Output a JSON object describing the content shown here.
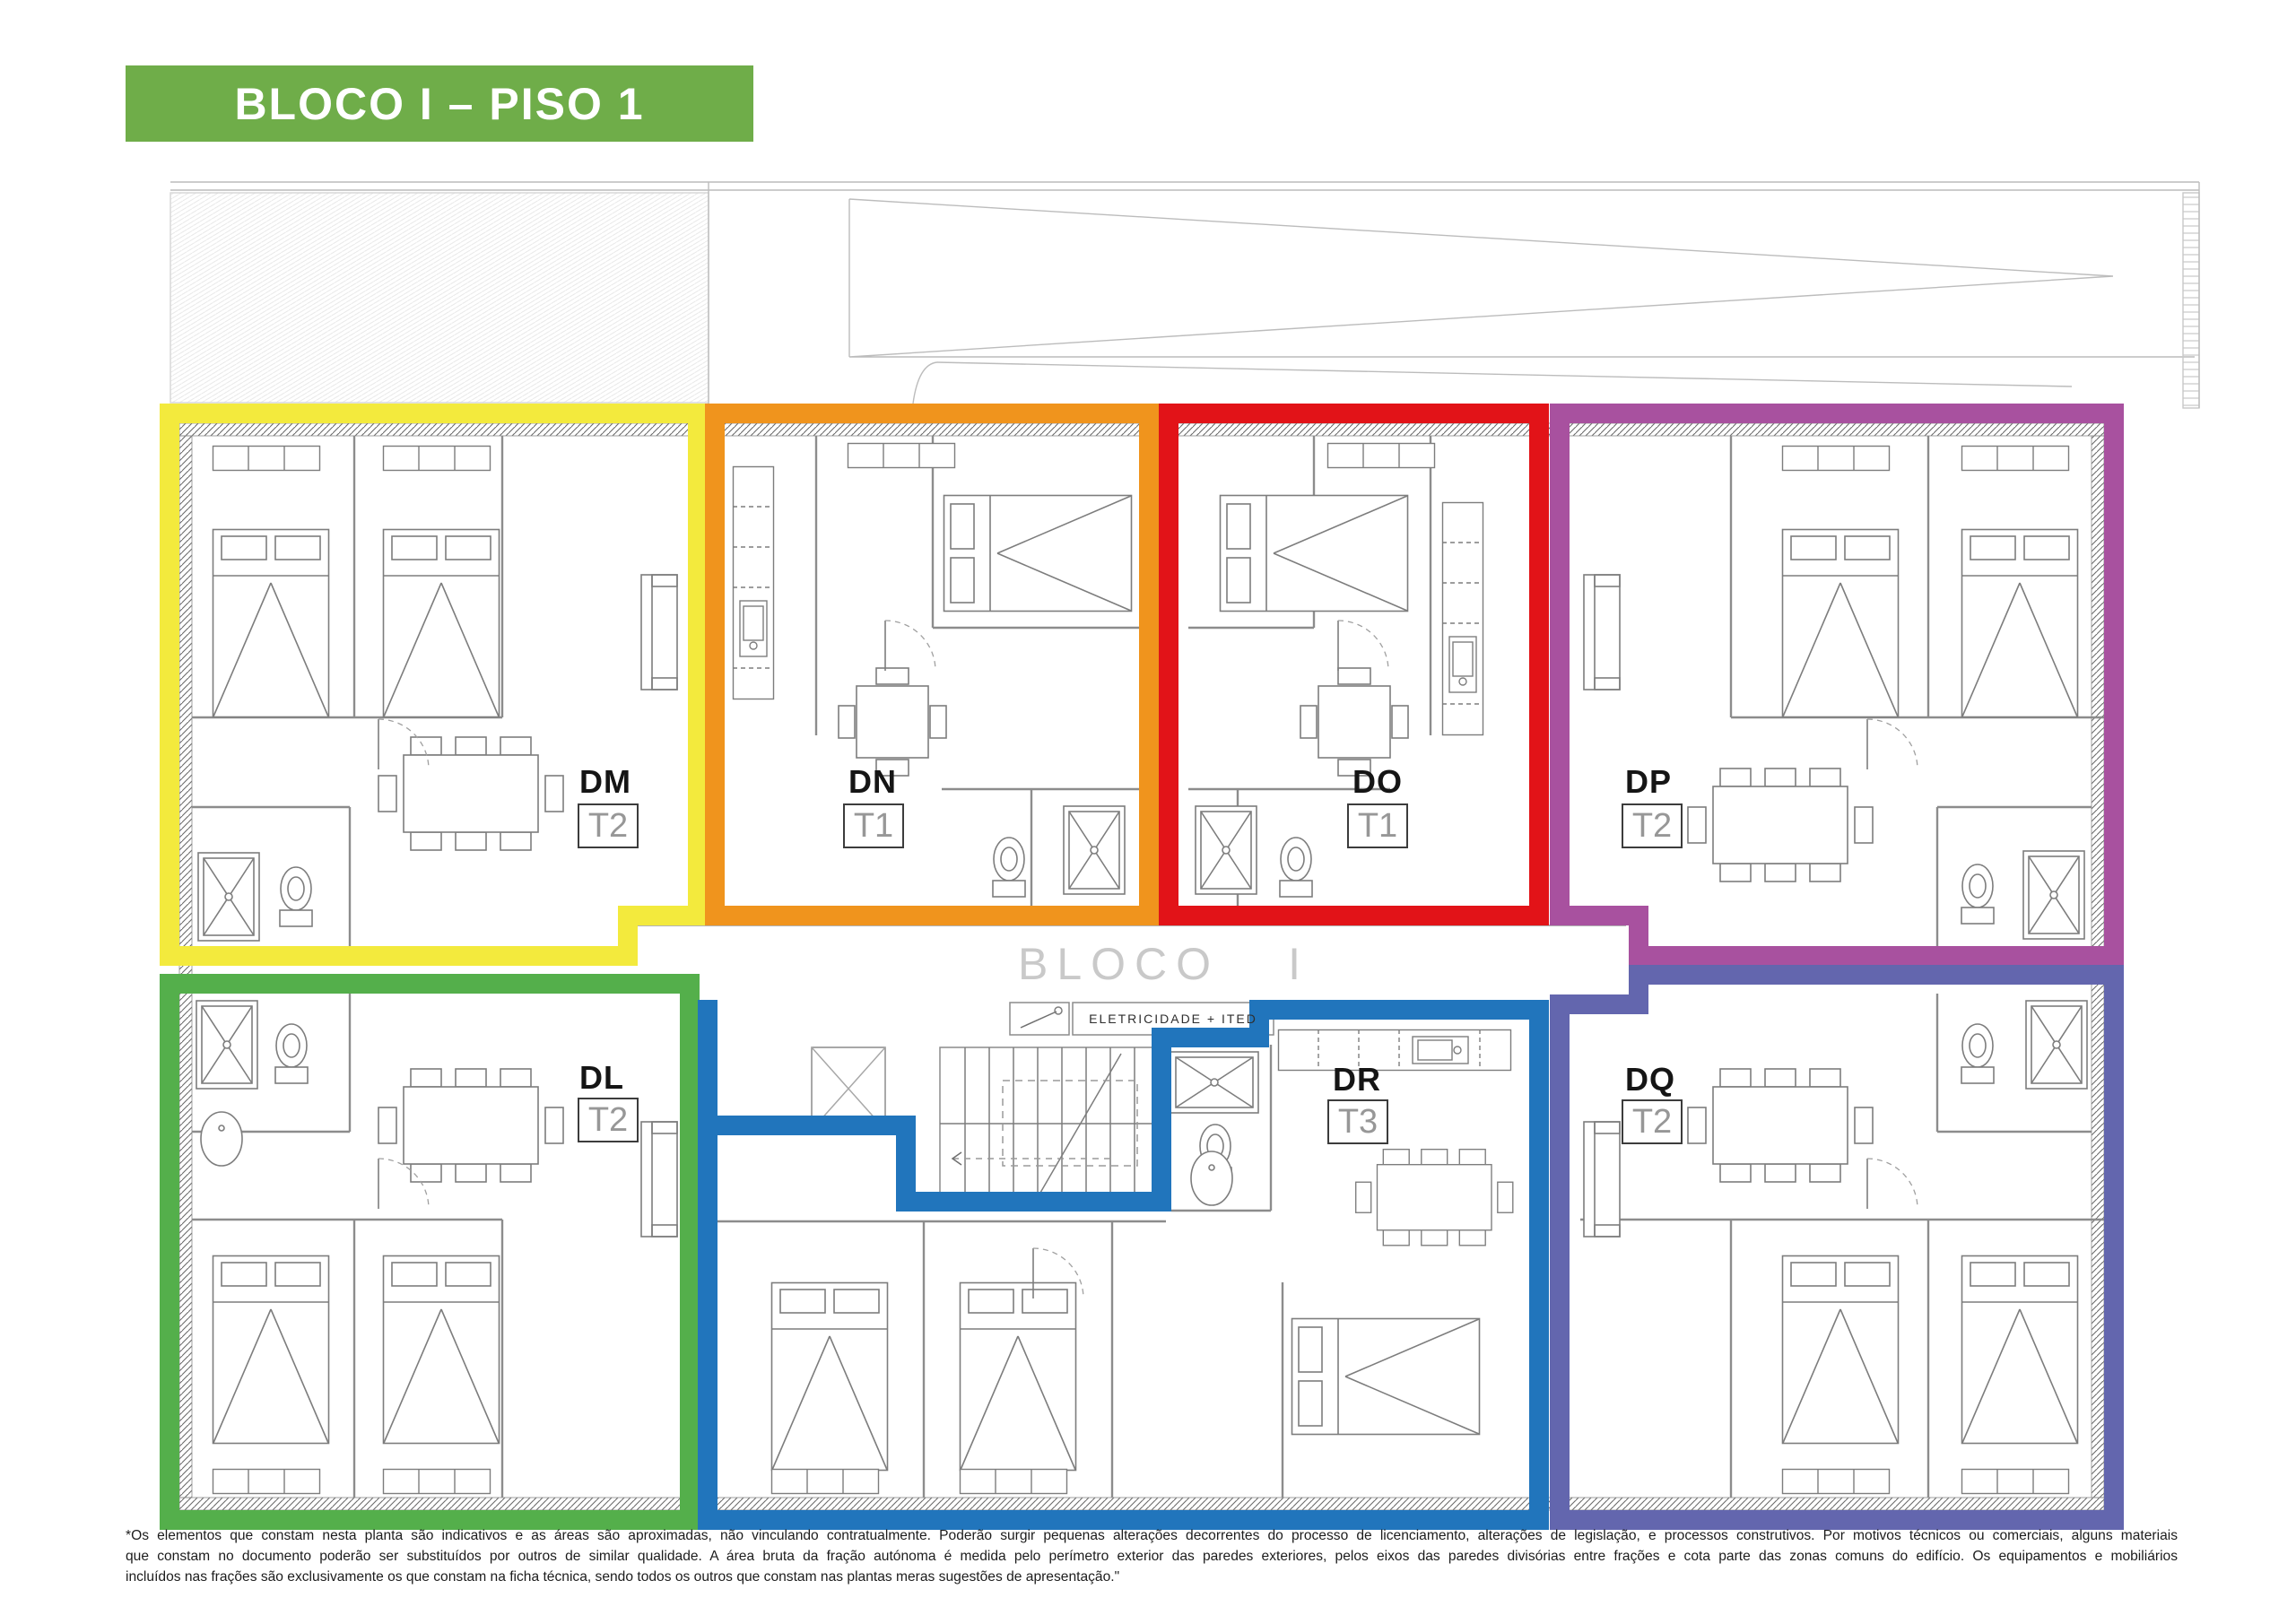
{
  "title": {
    "label": "BLOCO I – PISO 1",
    "background": "#6FAD49",
    "text_color": "#FFFFFF"
  },
  "corridor": {
    "block_word": "BLOCO",
    "block_numeral": "I",
    "electrical_label": "ELETRICIDADE  +  ITED"
  },
  "units": [
    {
      "code": "DM",
      "type": "T2",
      "color": "#F3EA3D"
    },
    {
      "code": "DN",
      "type": "T1",
      "color": "#F0941D"
    },
    {
      "code": "DO",
      "type": "T1",
      "color": "#E21318"
    },
    {
      "code": "DP",
      "type": "T2",
      "color": "#A8519F"
    },
    {
      "code": "DL",
      "type": "T2",
      "color": "#54AF4B"
    },
    {
      "code": "DR",
      "type": "T3",
      "color": "#2175BC"
    },
    {
      "code": "DQ",
      "type": "T2",
      "color": "#6366AE"
    }
  ],
  "disclaimer": {
    "lines": [
      "*Os elementos que constam nesta planta são indicativos e as áreas são aproximadas, não vinculando contratualmente. Poderão surgir pequenas alterações decorrentes do processo de licenciamento, alterações de legislação, e processos construtivos. Por motivos técnicos ou comerciais, alguns materiais",
      "que constam no documento poderão ser substituídos por outros de similar qualidade. A área bruta da fração autónoma é medida pelo perímetro exterior das paredes exteriores, pelos eixos das paredes divisórias entre frações e cota parte das zonas comuns do edifício. Os equipamentos e mobiliários",
      "incluídos nas frações são exclusivamente os que constam na ficha técnica, sendo todos os outros que constam nas plantas meras sugestões de apresentação.\""
    ]
  }
}
